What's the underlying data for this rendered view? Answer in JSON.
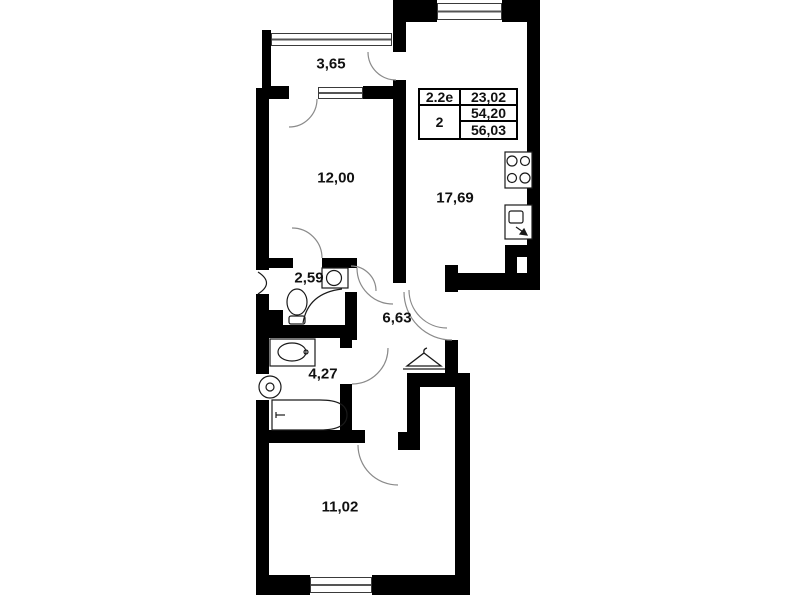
{
  "rooms": [
    {
      "key": "balcony",
      "area": "3,65"
    },
    {
      "key": "living-room",
      "area": "12,00"
    },
    {
      "key": "kitchen-living",
      "area": "17,69"
    },
    {
      "key": "wc",
      "area": "2,59"
    },
    {
      "key": "hallway",
      "area": "6,63"
    },
    {
      "key": "bathroom",
      "area": "4,27"
    },
    {
      "key": "bedroom",
      "area": "11,02"
    }
  ],
  "info_table": {
    "row1_left": "2.2е",
    "row1_right": "23,02",
    "row23_left": "2",
    "row2_right": "54,20",
    "row3_right": "56,03"
  },
  "icons": [
    "stove-icon",
    "kitchen-sink-icon",
    "washbasin-icon",
    "toilet-icon",
    "shower-icon",
    "bathtub-icon",
    "washer-icon",
    "hanger-icon",
    "door-arc",
    "window"
  ],
  "colors": {
    "wall": "#000000",
    "background": "#ffffff",
    "door_arc": "#8a8a8a",
    "fixture_line": "#1a1a1a"
  }
}
